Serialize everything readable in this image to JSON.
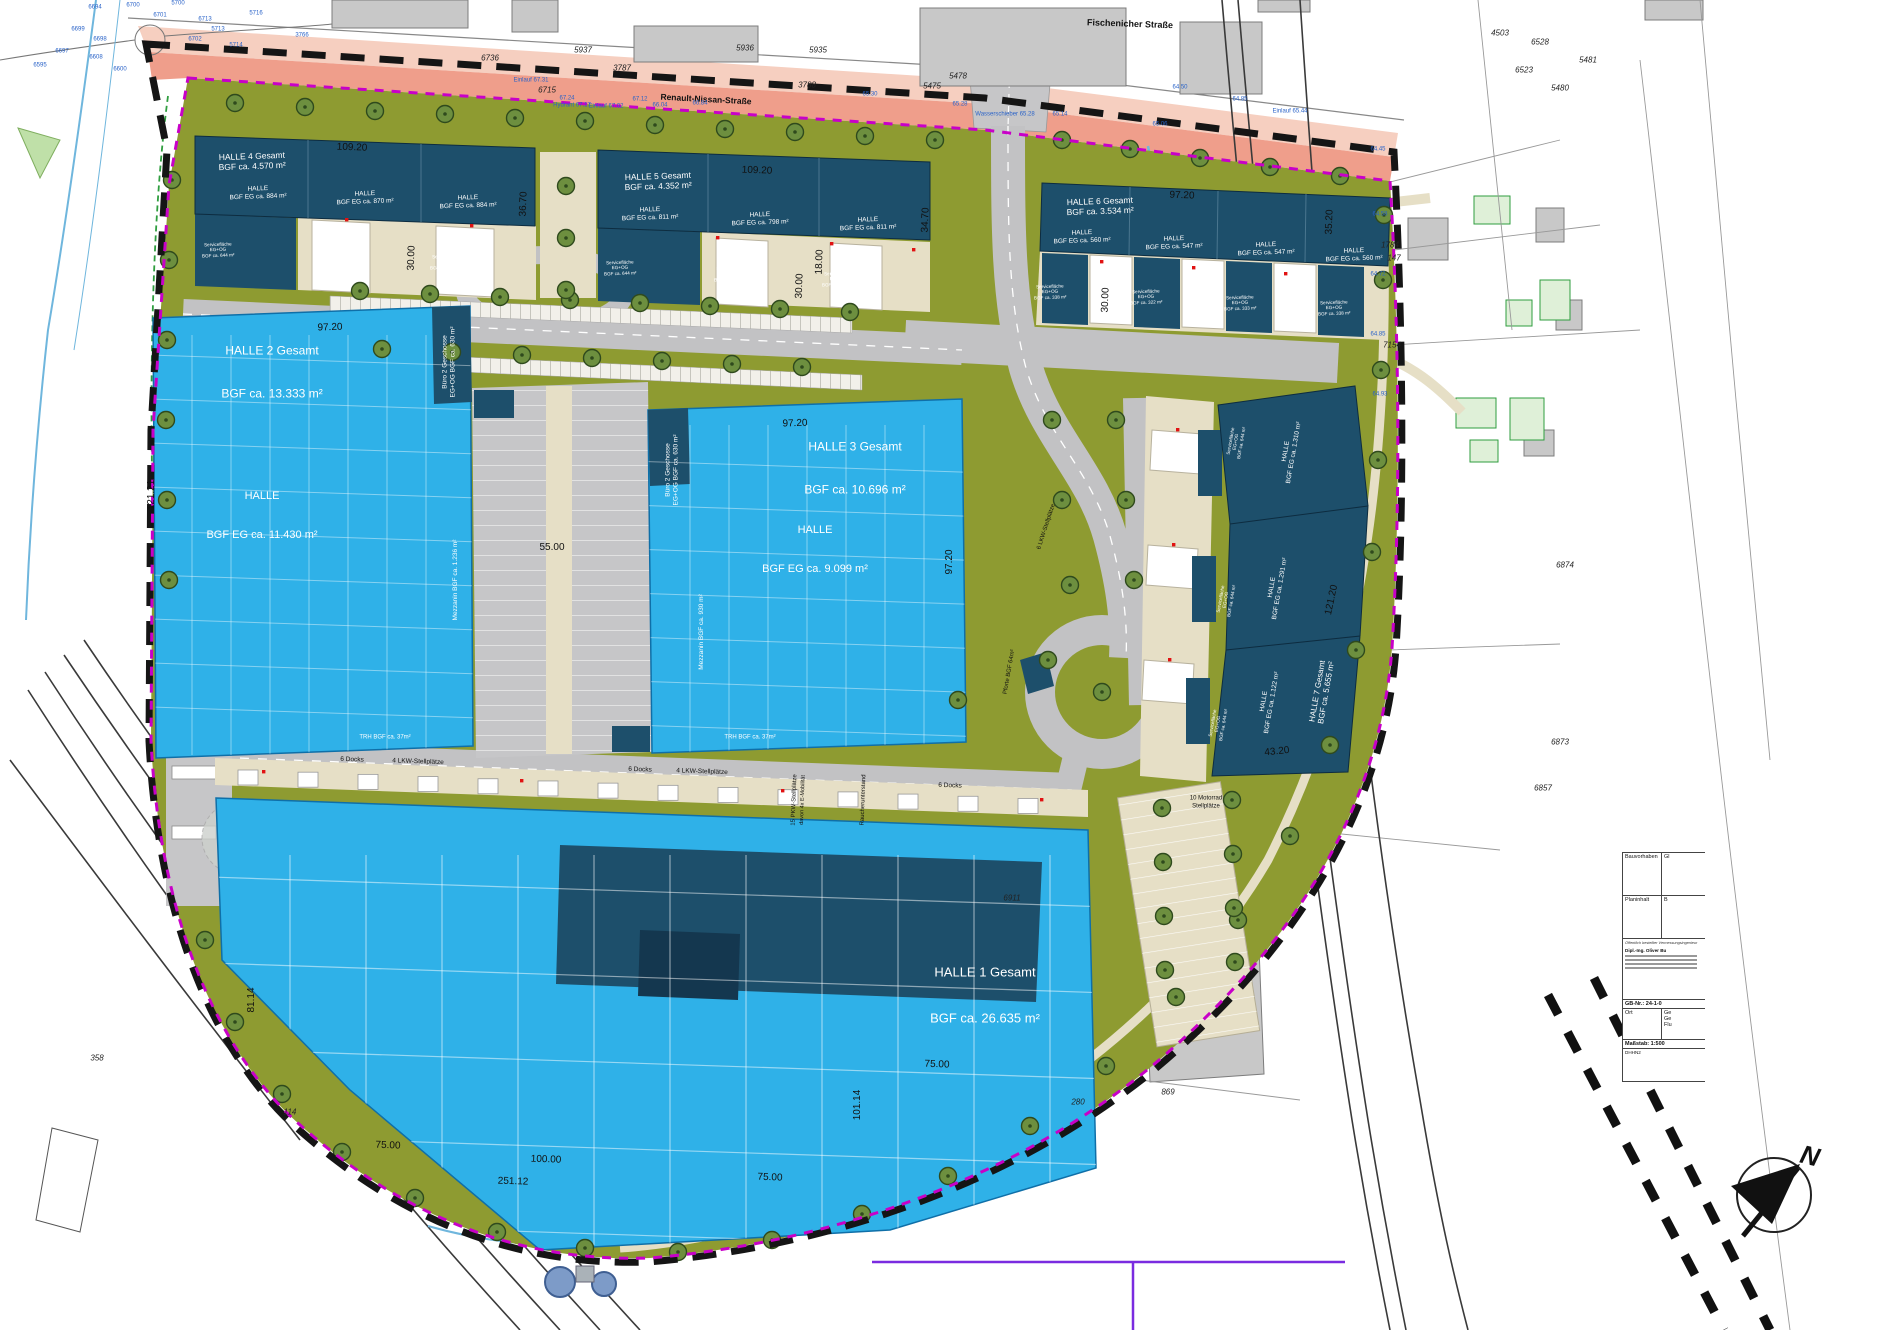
{
  "compass": {
    "n": "N"
  },
  "colors": {
    "hall_blue": "#2fb1e8",
    "navy": "#1d4f6b",
    "olive": "#8e9b31",
    "boundary_black": "#151515",
    "boundary_magenta": "#c800c8",
    "street_salmon": "#ef9e8b",
    "dock_beige": "#e6dfc6",
    "road_grey": "#c2c2c4"
  },
  "streets": {
    "top": "Fischenicher Straße",
    "main": "Renault-Nissan-Straße"
  },
  "halls": {
    "h1": {
      "title": "HALLE 1 Gesamt",
      "area": "BGF ca. 26.635 m²"
    },
    "h2": {
      "title": "HALLE 2 Gesamt",
      "area": "BGF ca. 13.333 m²",
      "hall": "HALLE",
      "hall_area": "BGF EG ca. 11.430 m²"
    },
    "h3": {
      "title": "HALLE 3 Gesamt",
      "area": "BGF ca. 10.696 m²",
      "hall": "HALLE",
      "hall_area": "BGF EG ca. 9.099 m²"
    }
  },
  "unit_labels": [
    {
      "lines": [
        "HALLE 4 Gesamt",
        "BGF ca. 4.570 m²"
      ],
      "x": 252,
      "y": 161,
      "r": -2,
      "s": 8.5
    },
    {
      "lines": [
        "HALLE",
        "BGF EG ca. 884 m²"
      ],
      "x": 258,
      "y": 193,
      "r": -2,
      "s": 6.5
    },
    {
      "lines": [
        "HALLE",
        "BGF EG ca. 870 m²"
      ],
      "x": 365,
      "y": 198,
      "r": -2,
      "s": 6.5
    },
    {
      "lines": [
        "HALLE",
        "BGF EG ca. 884 m²"
      ],
      "x": 468,
      "y": 202,
      "r": -2,
      "s": 6.5
    },
    {
      "lines": [
        "Servicefläche",
        "EG+OG",
        "BGF ca. 644 m²"
      ],
      "x": 218,
      "y": 250,
      "r": -2,
      "s": 4.6
    },
    {
      "lines": [
        "Servicefläche",
        "EG+OG",
        "BGF ca. 644 m²"
      ],
      "x": 332,
      "y": 256,
      "r": -2,
      "s": 4.6
    },
    {
      "lines": [
        "Servicefläche",
        "EG+OG",
        "BGF ca. 644 m²"
      ],
      "x": 446,
      "y": 262,
      "r": -2,
      "s": 4.6
    },
    {
      "lines": [
        "HALLE 5 Gesamt",
        "BGF ca. 4.352 m²"
      ],
      "x": 658,
      "y": 181,
      "r": -2,
      "s": 8.5
    },
    {
      "lines": [
        "HALLE",
        "BGF EG ca. 811 m²"
      ],
      "x": 650,
      "y": 214,
      "r": -2,
      "s": 6.5
    },
    {
      "lines": [
        "HALLE",
        "BGF EG ca. 798 m²"
      ],
      "x": 760,
      "y": 219,
      "r": -2,
      "s": 6.5
    },
    {
      "lines": [
        "HALLE",
        "BGF EG ca. 811 m²"
      ],
      "x": 868,
      "y": 224,
      "r": -2,
      "s": 6.5
    },
    {
      "lines": [
        "Servicefläche",
        "EG+OG",
        "BGF ca. 644 m²"
      ],
      "x": 620,
      "y": 268,
      "r": -2,
      "s": 4.6
    },
    {
      "lines": [
        "Servicefläche",
        "EG+OG",
        "BGF ca. 644 m²"
      ],
      "x": 730,
      "y": 274,
      "r": -2,
      "s": 4.6
    },
    {
      "lines": [
        "Servicefläche",
        "EG+OG",
        "BGF ca. 644 m²"
      ],
      "x": 838,
      "y": 279,
      "r": -2,
      "s": 4.6
    },
    {
      "lines": [
        "HALLE 6 Gesamt",
        "BGF ca. 3.534 m²"
      ],
      "x": 1100,
      "y": 206,
      "r": -2,
      "s": 8.5
    },
    {
      "lines": [
        "HALLE",
        "BGF EG ca. 560 m²"
      ],
      "x": 1082,
      "y": 237,
      "r": -2,
      "s": 6.5
    },
    {
      "lines": [
        "HALLE",
        "BGF EG ca. 547 m²"
      ],
      "x": 1174,
      "y": 243,
      "r": -2,
      "s": 6.5
    },
    {
      "lines": [
        "HALLE",
        "BGF EG ca. 547 m²"
      ],
      "x": 1266,
      "y": 249,
      "r": -2,
      "s": 6.5
    },
    {
      "lines": [
        "HALLE",
        "BGF EG ca. 560 m²"
      ],
      "x": 1354,
      "y": 255,
      "r": -2,
      "s": 6.5
    },
    {
      "lines": [
        "Servicefläche",
        "EG+OG",
        "BGF ca. 338 m²"
      ],
      "x": 1050,
      "y": 292,
      "r": -2,
      "s": 4.6
    },
    {
      "lines": [
        "Servicefläche",
        "EG+OG",
        "BGF ca. 322 m²"
      ],
      "x": 1146,
      "y": 297,
      "r": -2,
      "s": 4.6
    },
    {
      "lines": [
        "Servicefläche",
        "EG+OG",
        "BGF ca. 333 m²"
      ],
      "x": 1240,
      "y": 303,
      "r": -2,
      "s": 4.6
    },
    {
      "lines": [
        "Servicefläche",
        "EG+OG",
        "BGF ca. 338 m²"
      ],
      "x": 1334,
      "y": 308,
      "r": -2,
      "s": 4.6
    },
    {
      "lines": [
        "HALLE",
        "BGF EG ca. 1.310 m²"
      ],
      "x": 1290,
      "y": 452,
      "r": -80,
      "s": 6.5
    },
    {
      "lines": [
        "HALLE",
        "BGF EG ca. 1.291 m²"
      ],
      "x": 1276,
      "y": 588,
      "r": -80,
      "s": 6.5
    },
    {
      "lines": [
        "HALLE",
        "BGF EG ca. 1.122 m²"
      ],
      "x": 1268,
      "y": 702,
      "r": -80,
      "s": 6.5
    },
    {
      "lines": [
        "HALLE 7 Gesamt",
        "BGF ca. 5.655 m²"
      ],
      "x": 1322,
      "y": 692,
      "r": -80,
      "s": 8
    },
    {
      "lines": [
        "Servicefläche",
        "EG+OG",
        "BGF ca. 644 m²"
      ],
      "x": 1236,
      "y": 442,
      "r": -80,
      "s": 4.6
    },
    {
      "lines": [
        "Servicefläche",
        "EG+OG",
        "BGF ca. 644 m²"
      ],
      "x": 1226,
      "y": 600,
      "r": -80,
      "s": 4.6
    },
    {
      "lines": [
        "Servicefläche",
        "EG+OG",
        "BGF ca. 644 m²"
      ],
      "x": 1218,
      "y": 724,
      "r": -80,
      "s": 4.6
    },
    {
      "lines": [
        "Büro 2 Geschosse",
        "EG+OG BGF ca. 630 m²"
      ],
      "x": 449,
      "y": 362,
      "r": -90,
      "s": 6.5
    },
    {
      "lines": [
        "Mezzanin BGF ca. 1.236 m²"
      ],
      "x": 456,
      "y": 580,
      "r": -90,
      "s": 6.5
    },
    {
      "lines": [
        "TRH BGF ca. 37m²"
      ],
      "x": 385,
      "y": 738,
      "r": 0,
      "s": 6
    },
    {
      "lines": [
        "Büro 2 Geschosse",
        "EG+OG BGF ca. 630 m²"
      ],
      "x": 672,
      "y": 470,
      "r": -90,
      "s": 6.5
    },
    {
      "lines": [
        "Mezzanin BGF ca. 930 m²"
      ],
      "x": 702,
      "y": 632,
      "r": -90,
      "s": 6.5
    },
    {
      "lines": [
        "TRH BGF ca. 37m²"
      ],
      "x": 750,
      "y": 738,
      "r": 0,
      "s": 6
    }
  ],
  "dim_labels": [
    {
      "t": "109.20",
      "x": 352,
      "y": 148,
      "r": 2
    },
    {
      "t": "109.20",
      "x": 757,
      "y": 171,
      "r": 2
    },
    {
      "t": "97.20",
      "x": 1182,
      "y": 196,
      "r": 2
    },
    {
      "t": "36.70",
      "x": 524,
      "y": 204,
      "r": -88
    },
    {
      "t": "30.00",
      "x": 412,
      "y": 258,
      "r": -88
    },
    {
      "t": "30.00",
      "x": 800,
      "y": 286,
      "r": -88
    },
    {
      "t": "18.00",
      "x": 820,
      "y": 262,
      "r": -88
    },
    {
      "t": "34.70",
      "x": 926,
      "y": 220,
      "r": -88
    },
    {
      "t": "30.00",
      "x": 1106,
      "y": 300,
      "r": -88
    },
    {
      "t": "35.20",
      "x": 1330,
      "y": 222,
      "r": -88
    },
    {
      "t": "97.20",
      "x": 330,
      "y": 328,
      "r": -2
    },
    {
      "t": "121.21",
      "x": 152,
      "y": 495,
      "r": -90
    },
    {
      "t": "97.20",
      "x": 795,
      "y": 424,
      "r": -2
    },
    {
      "t": "97.20",
      "x": 950,
      "y": 562,
      "r": -90
    },
    {
      "t": "55.00",
      "x": 552,
      "y": 548,
      "r": 0
    },
    {
      "t": "121.20",
      "x": 1332,
      "y": 600,
      "r": -78
    },
    {
      "t": "43.20",
      "x": 1277,
      "y": 752,
      "r": -6
    },
    {
      "t": "81.14",
      "x": 252,
      "y": 1000,
      "r": -90
    },
    {
      "t": "101.14",
      "x": 858,
      "y": 1105,
      "r": -90
    },
    {
      "t": "75.00",
      "x": 388,
      "y": 1146,
      "r": 2
    },
    {
      "t": "100.00",
      "x": 546,
      "y": 1160,
      "r": 2
    },
    {
      "t": "251.12",
      "x": 513,
      "y": 1182,
      "r": 2
    },
    {
      "t": "75.00",
      "x": 770,
      "y": 1178,
      "r": 2
    },
    {
      "t": "75.00",
      "x": 937,
      "y": 1065,
      "r": 2
    }
  ],
  "notes": [
    {
      "t": "Fischenicher Straße",
      "x": 1130,
      "y": 24,
      "r": 2,
      "s": 9,
      "b": true,
      "n": "street-label-fischenicher"
    },
    {
      "t": "Renault-Nissan-Straße",
      "x": 706,
      "y": 99,
      "r": 3,
      "s": 8.5,
      "b": true,
      "n": "street-label-renault-nissan"
    },
    {
      "t": "6 Docks",
      "x": 352,
      "y": 760,
      "r": 2,
      "s": 6.5
    },
    {
      "t": "4 LKW-Stellplätze",
      "x": 418,
      "y": 762,
      "r": 2,
      "s": 6.5
    },
    {
      "t": "6 Docks",
      "x": 640,
      "y": 770,
      "r": 2,
      "s": 6.5
    },
    {
      "t": "4 LKW-Stellplätze",
      "x": 702,
      "y": 772,
      "r": 2,
      "s": 6.5
    },
    {
      "t": "6 Docks",
      "x": 950,
      "y": 786,
      "r": 2,
      "s": 6.5
    },
    {
      "t": "15 PKW-Stellplätze",
      "x": 795,
      "y": 800,
      "r": -88,
      "s": 6
    },
    {
      "t": "davon 4x E-Mobilität",
      "x": 803,
      "y": 800,
      "r": -88,
      "s": 5.5
    },
    {
      "t": "Raucherunterstand",
      "x": 864,
      "y": 800,
      "r": -88,
      "s": 6
    },
    {
      "t": "6 LKW-Stellplätze",
      "x": 1047,
      "y": 527,
      "r": -72,
      "s": 6
    },
    {
      "t": "10 Motorrad",
      "x": 1206,
      "y": 799,
      "r": 0,
      "s": 6
    },
    {
      "t": "Stellplätze",
      "x": 1206,
      "y": 807,
      "r": 0,
      "s": 6
    },
    {
      "t": "Pforte BGF 64m²",
      "x": 1010,
      "y": 672,
      "r": -80,
      "s": 6
    }
  ],
  "parcels_black": [
    {
      "t": "6736",
      "x": 490,
      "y": 58
    },
    {
      "t": "5937",
      "x": 583,
      "y": 50
    },
    {
      "t": "5936",
      "x": 745,
      "y": 48
    },
    {
      "t": "5935",
      "x": 818,
      "y": 50
    },
    {
      "t": "3787",
      "x": 622,
      "y": 68
    },
    {
      "t": "3788",
      "x": 807,
      "y": 85
    },
    {
      "t": "6715",
      "x": 547,
      "y": 90
    },
    {
      "t": "5475",
      "x": 932,
      "y": 86
    },
    {
      "t": "5478",
      "x": 958,
      "y": 76
    },
    {
      "t": "4503",
      "x": 1500,
      "y": 33
    },
    {
      "t": "6528",
      "x": 1540,
      "y": 42
    },
    {
      "t": "6523",
      "x": 1524,
      "y": 70
    },
    {
      "t": "5481",
      "x": 1588,
      "y": 60
    },
    {
      "t": "5480",
      "x": 1560,
      "y": 88
    },
    {
      "t": "7154",
      "x": 1392,
      "y": 345
    },
    {
      "t": "1784",
      "x": 1390,
      "y": 245
    },
    {
      "t": "147",
      "x": 1394,
      "y": 258
    },
    {
      "t": "6874",
      "x": 1565,
      "y": 565
    },
    {
      "t": "6873",
      "x": 1560,
      "y": 742
    },
    {
      "t": "6857",
      "x": 1543,
      "y": 788
    },
    {
      "t": "6911",
      "x": 1012,
      "y": 898
    },
    {
      "t": "869",
      "x": 1168,
      "y": 1092
    },
    {
      "t": "280",
      "x": 1078,
      "y": 1102
    },
    {
      "t": "114",
      "x": 290,
      "y": 1112
    },
    {
      "t": "358",
      "x": 97,
      "y": 1058
    }
  ],
  "cadastral_blue": [
    {
      "t": "6694",
      "x": 95,
      "y": 8
    },
    {
      "t": "6700",
      "x": 133,
      "y": 6
    },
    {
      "t": "6713",
      "x": 205,
      "y": 20
    },
    {
      "t": "6698",
      "x": 100,
      "y": 40
    },
    {
      "t": "6699",
      "x": 78,
      "y": 30
    },
    {
      "t": "6701",
      "x": 160,
      "y": 16
    },
    {
      "t": "6702",
      "x": 195,
      "y": 40
    },
    {
      "t": "6697",
      "x": 62,
      "y": 52
    },
    {
      "t": "5700",
      "x": 178,
      "y": 4
    },
    {
      "t": "5713",
      "x": 218,
      "y": 30
    },
    {
      "t": "5714",
      "x": 236,
      "y": 46
    },
    {
      "t": "5716",
      "x": 256,
      "y": 14
    },
    {
      "t": "3766",
      "x": 302,
      "y": 36
    },
    {
      "t": "6608",
      "x": 96,
      "y": 58
    },
    {
      "t": "6595",
      "x": 40,
      "y": 66
    },
    {
      "t": "6600",
      "x": 120,
      "y": 70
    },
    {
      "t": "Einlauf 67.31",
      "x": 531,
      "y": 81
    },
    {
      "t": "Hydrant 67.17",
      "x": 572,
      "y": 106
    },
    {
      "t": "Einlauf 67.02",
      "x": 606,
      "y": 107
    },
    {
      "t": "67.24",
      "x": 567,
      "y": 99
    },
    {
      "t": "67.12",
      "x": 640,
      "y": 100
    },
    {
      "t": "66.84",
      "x": 700,
      "y": 104
    },
    {
      "t": "66.04",
      "x": 660,
      "y": 106
    },
    {
      "t": "Wasserschieber 65.28",
      "x": 1005,
      "y": 115
    },
    {
      "t": "Einlauf 65.44",
      "x": 1290,
      "y": 112
    },
    {
      "t": "65.30",
      "x": 870,
      "y": 95
    },
    {
      "t": "65.28",
      "x": 960,
      "y": 105
    },
    {
      "t": "65.14",
      "x": 1060,
      "y": 115
    },
    {
      "t": "65.06",
      "x": 1160,
      "y": 125
    },
    {
      "t": "64.85",
      "x": 1240,
      "y": 100
    },
    {
      "t": "64.50",
      "x": 1180,
      "y": 88
    },
    {
      "t": "64.45",
      "x": 1378,
      "y": 150
    },
    {
      "t": "64.58",
      "x": 1380,
      "y": 215
    },
    {
      "t": "64.72",
      "x": 1378,
      "y": 275
    },
    {
      "t": "64.85",
      "x": 1378,
      "y": 335
    },
    {
      "t": "64.93",
      "x": 1380,
      "y": 395
    }
  ],
  "titleblock": {
    "row1_label": "Bauvorhaben",
    "row1_value": "Gl",
    "row2_label": "Planinhalt",
    "row2_value": "B",
    "stamp": "Öffentlich bestellter Vermessungsingenieur",
    "engineer": "Dipl.-Ing. Oliver Bu",
    "gb_label": "GB-Nr.:",
    "gb_value": "24-1-0",
    "ort_label": "Ort",
    "ort_values": [
      "Ge",
      "Ge",
      "Flu"
    ],
    "scale": "Maßstab: 1:500",
    "datum": "DHHN2"
  }
}
